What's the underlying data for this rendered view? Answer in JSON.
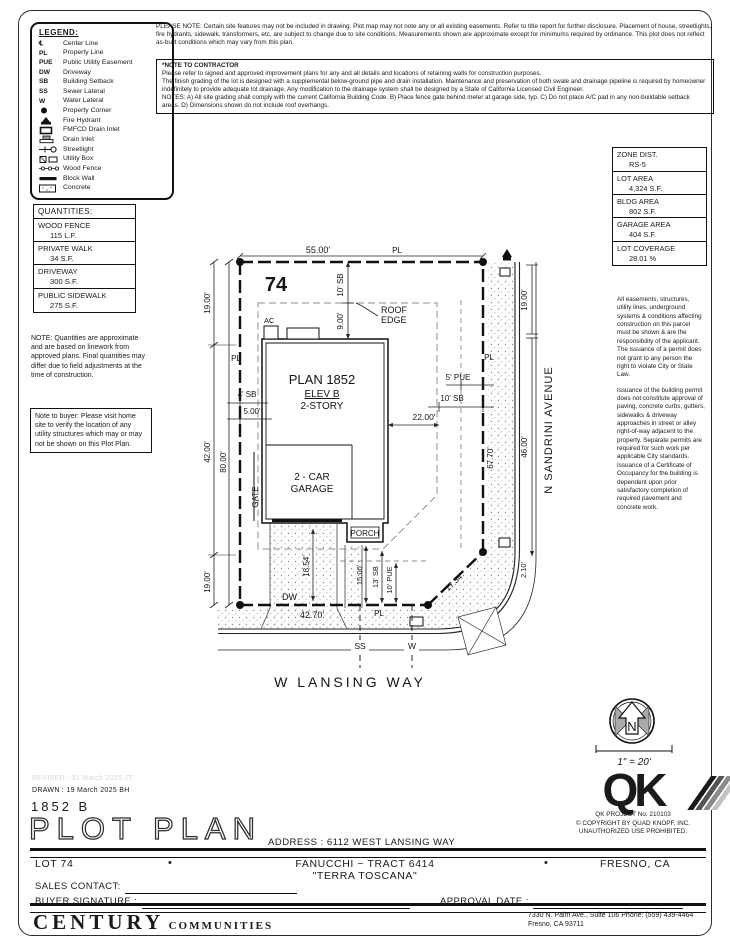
{
  "top_notes": {
    "please_note": "PLEASE NOTE:  Certain site features may not be included in drawing.  Plot map may not note any or all existing easements.  Refer to title report for further disclosure.  Placement of house, streetlights, fire hydrants, sidewalk, transformers, etc. are subject to change due to site conditions.  Measurements shown are approximate except for minimums required by ordinance.  This plot does not reflect as-built conditions which may vary from this plan.",
    "contractor_title": "*NOTE TO CONTRACTOR",
    "contractor_body": "Please refer to signed and approved improvement plans for any and all details and locations of retaining walls for construction purposes.\nThe finish grading of the lot is designed with a supplemental below-ground pipe and drain installation.  Maintenance and preservation of both swale and drainage pipeline is required by homeowner indefinitely to provide adequate lot drainage.  Any modification to the drainage system shall be designed by a State of California Licensed Civil Engineer.\nNOTES:  A) All site grading shall comply with the current California Building Code.  B) Place fence gate behind meter at garage side, typ.  C) Do not place A/C pad in any non-buildable setback areas.  D) Dimensions shown do not include roof overhangs."
  },
  "legend": {
    "title": "LEGEND:",
    "items": [
      {
        "sym": "℄",
        "label": "Center Line"
      },
      {
        "sym": "PL",
        "label": "Property Line"
      },
      {
        "sym": "PUE",
        "label": "Public Utility Easement"
      },
      {
        "sym": "DW",
        "label": "Driveway"
      },
      {
        "sym": "SB",
        "label": "Building Setback"
      },
      {
        "sym": "SS",
        "label": "Sewer Lateral"
      },
      {
        "sym": "W",
        "label": "Water Lateral"
      },
      {
        "label": "Property Corner"
      },
      {
        "label": "Fire Hydrant"
      },
      {
        "label": "FMFCD Drain Inlet"
      },
      {
        "label": "Drain Inlet"
      },
      {
        "label": "Streetlight"
      },
      {
        "label": "Utility Box"
      },
      {
        "label": "Wood Fence"
      },
      {
        "label": "Block Wall"
      },
      {
        "label": "Concrete"
      }
    ]
  },
  "quantities": {
    "title": "QUANTITIES:",
    "items": [
      {
        "name": "WOOD FENCE",
        "value": "115 L.F."
      },
      {
        "name": "PRIVATE WALK",
        "value": "34 S.F."
      },
      {
        "name": "DRIVEWAY",
        "value": "300 S.F."
      },
      {
        "name": "PUBLIC SIDEWALK",
        "value": "275 S.F."
      }
    ],
    "note": "NOTE: Quantities are approximate and are based on linework from approved plans.  Final quantities may differ due to field adjustments at the time of construction.",
    "buyer_note": "Note to buyer: Please visit home site to verify the location of any utility structures which may or may not be shown on this Plot Plan."
  },
  "zone": {
    "items": [
      {
        "name": "ZONE DIST.",
        "value": "RS-5"
      },
      {
        "name": "LOT AREA",
        "value": "4,324 S.F."
      },
      {
        "name": "BLDG AREA",
        "value": "802 S.F."
      },
      {
        "name": "GARAGE AREA",
        "value": "404 S.F."
      },
      {
        "name": "LOT COVERAGE",
        "value": "28.01 %"
      }
    ],
    "legal1": "All easements, structures, utility lines, underground systems & conditions affecting construction on this parcel must be shown & are the responsibility of the applicant. The issuance of a permit does not grant to any person the right to violate City or State Law.",
    "legal2": "Issuance of the building permit does not constitute approval of paving, concrete curbs, gutters, sidewalks & driveway approaches in street or alley right-of-way adjacent to the property. Separate permits are required for such work per applicable City standards. Issuance of a Certificate of Occupancy for the building is dependent upon prior satisfactory completion of required pavement and concrete work."
  },
  "plot": {
    "lot_number": "74",
    "pl": "PL",
    "dim_top": "55.00'",
    "dim_left_top": "19.00'",
    "dim_left_mid": "42.00'",
    "dim_left_bot": "19.00'",
    "dim_left_total": "80.00'",
    "dim_right_top": "19.00'",
    "dim_right_front": "46.00'",
    "dim_right_total": "67.70'",
    "dim_corner": "17.34'",
    "dim_corner_curb": "2.10'",
    "dim_bottom": "42.70'",
    "sb_top": "10' SB",
    "roof_offset": "9.00'",
    "sb_left": "4' SB",
    "left_offset": "5.00'",
    "pue_right": "5' PUE",
    "sb_right": "10' SB",
    "dim_house_right": "22.00'",
    "dim_walk": "18.54'",
    "dim_porch_pl": "15.00'",
    "sb_bottom": "13' SB",
    "pue_bottom": "10' PUE",
    "ac": "AC",
    "roof_edge_1": "ROOF",
    "roof_edge_2": "EDGE",
    "plan": "PLAN 1852",
    "elev": "ELEV B",
    "story": "2-STORY",
    "garage_1": "2 - CAR",
    "garage_2": "GARAGE",
    "porch": "PORCH",
    "gate": "GATE",
    "dw": "DW",
    "ss": "SS",
    "w": "W",
    "street_right": "N SANDRINI AVENUE",
    "street_bottom": "W LANSING WAY"
  },
  "compass": {
    "n": "N",
    "scale": "1\" = 20'"
  },
  "qk": {
    "logo": "QK",
    "project": "QK PROJECT No. 210103",
    "copyright": "©   COPYRIGHT BY QUAD KNOPF, INC.",
    "use": "UNAUTHORIZED USE PROHIBITED."
  },
  "title_block": {
    "revised": "REVISED :  31 March 2025   JT",
    "drawn": "DRAWN :  19 March 2025   BH",
    "model": "1852  B",
    "title": "PLOT PLAN",
    "address": "ADDRESS :   6112 WEST LANSING WAY",
    "lot": "LOT 74",
    "bullet": "•",
    "tract": "FANUCCHI ~ TRACT 6414",
    "tract2": "\"TERRA TOSCANA\"",
    "city": "FRESNO, CA",
    "sales_label": "SALES CONTACT:",
    "buyer_label": "BUYER SIGNATURE :",
    "approval_label": "APPROVAL DATE :"
  },
  "footer": {
    "brand1": "CENTURY",
    "brand2": "COMMUNITIES",
    "address1": "7330 N. Palm Ave., Suite 106    Phone:  (559) 439-4464",
    "address2": "Fresno, CA  93711"
  }
}
